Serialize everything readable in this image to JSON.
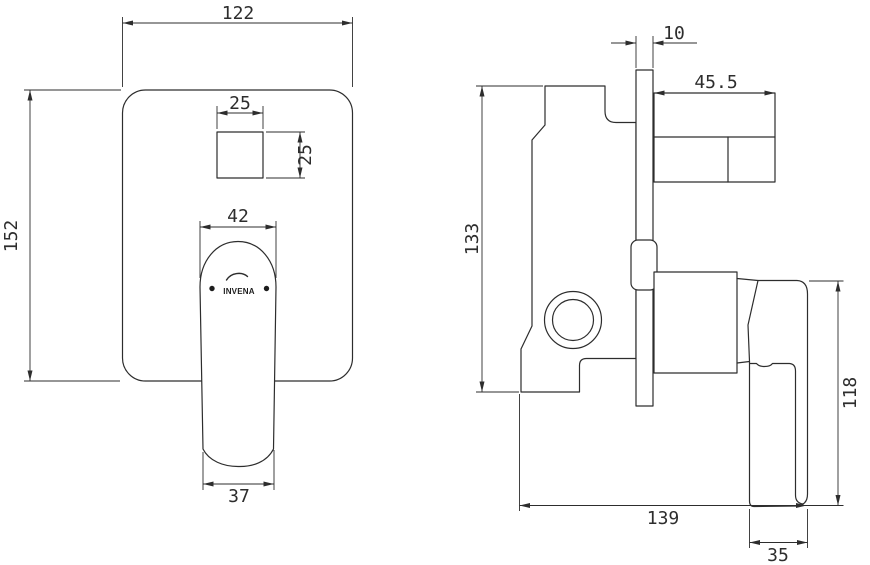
{
  "drawing": {
    "title": "mixer-technical-drawing",
    "line_color": "#2d2d2d",
    "background": "#ffffff",
    "front_view": {
      "logo_text": "INVENA",
      "dims": {
        "plate_width": "122",
        "plate_height": "152",
        "button_width": "25",
        "button_height": "25",
        "handle_top_width": "42",
        "handle_bottom_width": "37"
      }
    },
    "side_view": {
      "dims": {
        "plate_thickness": "10",
        "spout_depth": "45.5",
        "body_height": "133",
        "lever_length": "118",
        "total_depth": "139",
        "lever_width": "35"
      }
    }
  }
}
